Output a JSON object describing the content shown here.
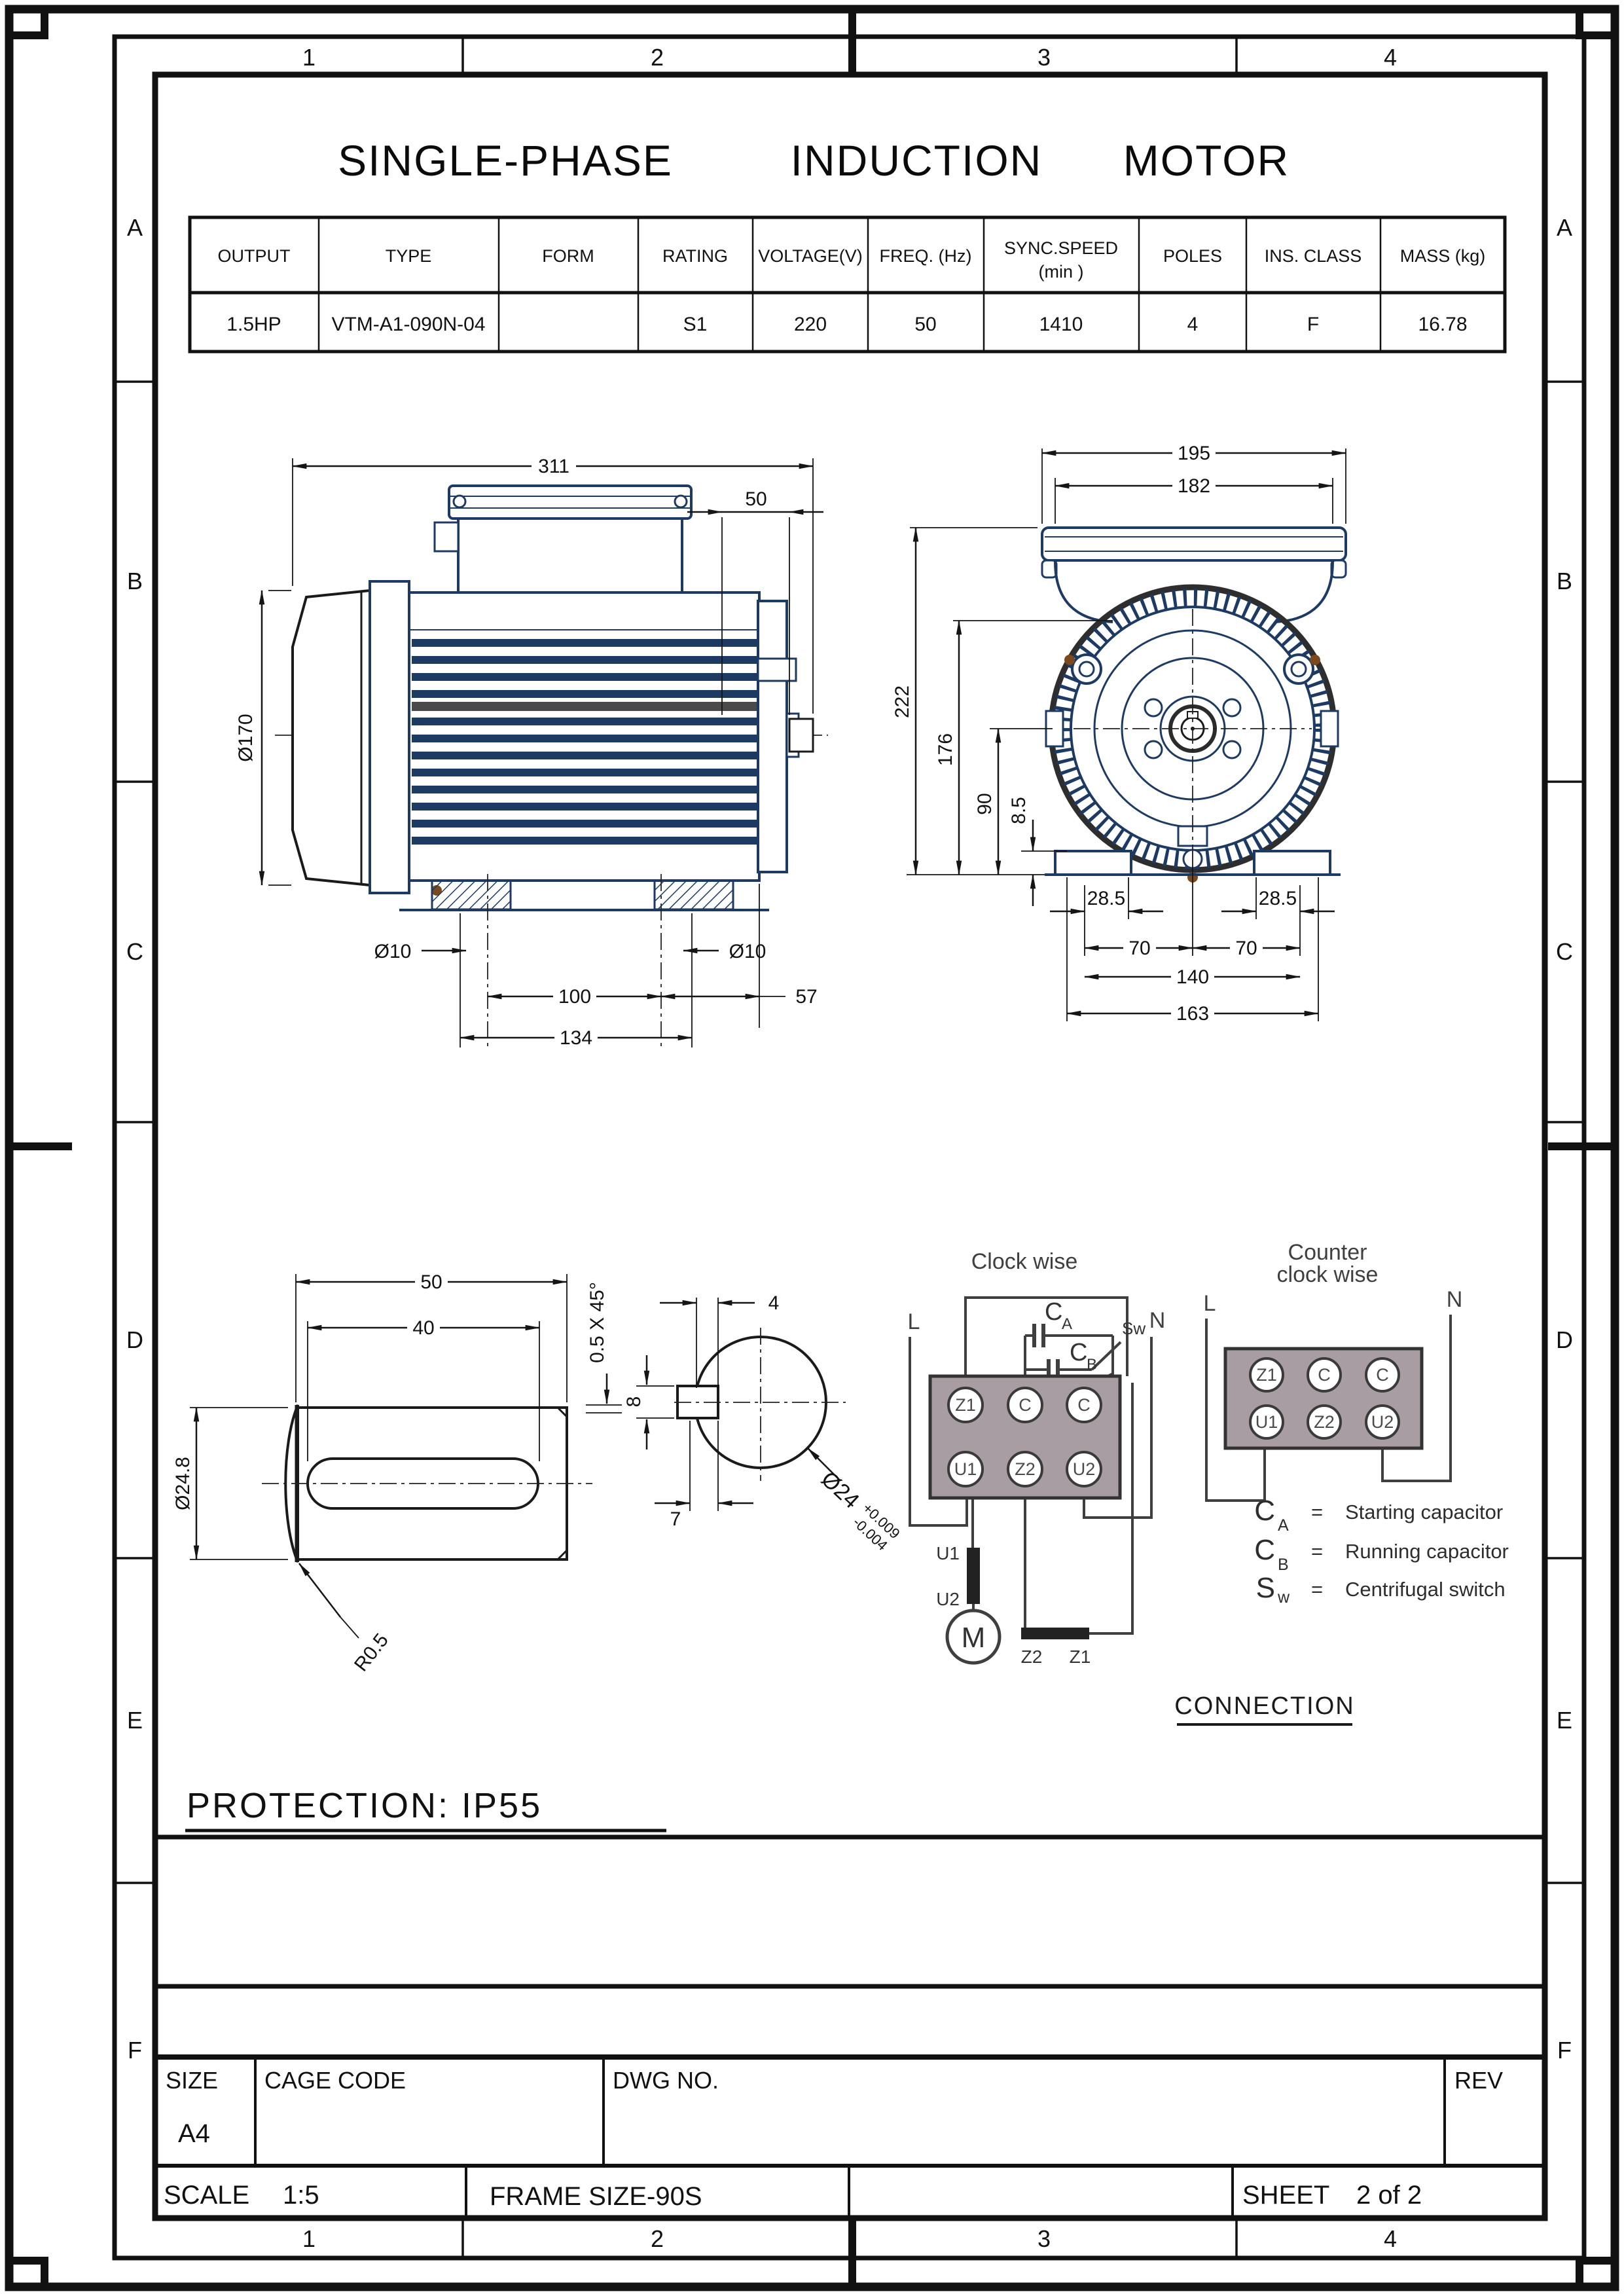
{
  "colors": {
    "ink": "#151515",
    "navy": "#1d3a63",
    "screw": "#7a4a1e",
    "block": "#a89da3",
    "wire": "#3f3f3f"
  },
  "zones": {
    "cols": [
      "1",
      "2",
      "3",
      "4"
    ],
    "rows": [
      "A",
      "B",
      "C",
      "D",
      "E",
      "F"
    ]
  },
  "title": {
    "part1": "SINGLE-PHASE",
    "part2": "INDUCTION",
    "part3": "MOTOR"
  },
  "spec": {
    "headers": [
      "OUTPUT",
      "TYPE",
      "FORM",
      "RATING",
      "VOLTAGE(V)",
      "FREQ. (Hz)",
      "SYNC.SPEED",
      "POLES",
      "INS. CLASS",
      "MASS (kg)"
    ],
    "sync_sub": "(min )",
    "values": [
      "1.5HP",
      "VTM-A1-090N-04",
      "",
      "S1",
      "220",
      "50",
      "1410",
      "4",
      "F",
      "16.78"
    ]
  },
  "dims": {
    "side": {
      "overall": "311",
      "shaft_len": "50",
      "fan_dia": "Ø170",
      "hole_left": "Ø10",
      "hole_right": "Ø10",
      "hole_span": "100",
      "foot_len": "134",
      "shaft_c": "57"
    },
    "end": {
      "box_w": "195",
      "box_inner": "182",
      "height": "222",
      "center_h": "176",
      "shaft_h": "90",
      "foot_t": "8.5",
      "edge_l": "28.5",
      "edge_r": "28.5",
      "half_l": "70",
      "half_r": "70",
      "hole_span": "140",
      "foot_span": "163"
    },
    "shaft": {
      "len": "50",
      "key_len": "40",
      "dia": "Ø24.8",
      "fillet": "R0.5",
      "chamfer": "0.5 X 45°"
    },
    "section": {
      "key_w": "4",
      "key_h": "8",
      "key_d": "7",
      "dia": "Ø24",
      "tol_plus": "+0.009",
      "tol_minus": "-0.004"
    }
  },
  "wiring": {
    "cw_title": "Clock wise",
    "ccw_title_1": "Counter",
    "ccw_title_2": "clock wise",
    "line": "L",
    "neutral": "N",
    "cap_sym": "C",
    "cap_a_sub": "A",
    "cap_b_sub": "B",
    "switch": "Sw",
    "terminals": [
      "Z1",
      "C",
      "C",
      "U1",
      "Z2",
      "U2"
    ],
    "u1": "U1",
    "u2": "U2",
    "motor": "M",
    "z2": "Z2",
    "z1": "Z1"
  },
  "legend": {
    "rows": [
      {
        "sym": "C",
        "sub": "A",
        "eq": "=",
        "label": "Starting capacitor"
      },
      {
        "sym": "C",
        "sub": "B",
        "eq": "=",
        "label": "Running capacitor"
      },
      {
        "sym": "S",
        "sub": "w",
        "eq": "=",
        "label": "Centrifugal switch"
      }
    ],
    "connection": "CONNECTION"
  },
  "protection": "PROTECTION: IP55",
  "title_block": {
    "size_label": "SIZE",
    "size_value": "A4",
    "cage_label": "CAGE CODE",
    "dwg_label": "DWG NO.",
    "rev_label": "REV",
    "scale_label": "SCALE",
    "scale_value": "1:5",
    "frame_label": "FRAME SIZE-90S",
    "sheet_label": "SHEET",
    "sheet_value": "2 of 2"
  }
}
